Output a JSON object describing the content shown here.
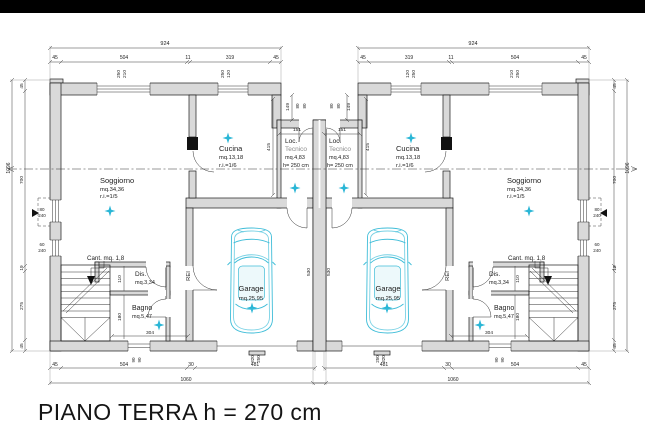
{
  "page": {
    "caption": "PIANO TERRA h = 270 cm"
  },
  "colors": {
    "letterbox": "#000000",
    "wall_fill": "#d9d9d9",
    "line": "#1a1a1a",
    "dimension": "#3c3c3c",
    "car_accent": "#3fbdd8",
    "star_accent": "#2ab6d6"
  },
  "rooms": [
    {
      "name": "Soggiorno",
      "area": "mq.34,36",
      "note": "r.i.=1/5"
    },
    {
      "name": "Cucina",
      "area": "mq.13,18",
      "note": "r.i.=1/6"
    },
    {
      "name": "Loc. Tecnico",
      "area": "mq.4,83",
      "note": "h= 250 cm"
    },
    {
      "name": "Garage",
      "area": "mq.25,95",
      "note": ""
    },
    {
      "name": "Dis.",
      "area": "mq.3,34",
      "note": ""
    },
    {
      "name": "Bagno",
      "area": "mq.5,47",
      "note": ""
    },
    {
      "name": "Cant.",
      "area": "mq. 1,8",
      "note": ""
    }
  ],
  "plan": {
    "labels": [
      {
        "t": "924",
        "x": 165,
        "y": 45,
        "s": 5.5
      },
      {
        "t": "924",
        "x": 473,
        "y": 45,
        "s": 5.5
      },
      {
        "t": "45",
        "x": 55,
        "y": 59,
        "s": 5
      },
      {
        "t": "504",
        "x": 124,
        "y": 59,
        "s": 5
      },
      {
        "t": "11",
        "x": 188,
        "y": 59,
        "s": 5
      },
      {
        "t": "319",
        "x": 230,
        "y": 59,
        "s": 5
      },
      {
        "t": "45",
        "x": 276,
        "y": 59,
        "s": 5
      },
      {
        "t": "45",
        "x": 363,
        "y": 59,
        "s": 5
      },
      {
        "t": "319",
        "x": 409,
        "y": 59,
        "s": 5
      },
      {
        "t": "11",
        "x": 451,
        "y": 59,
        "s": 5
      },
      {
        "t": "504",
        "x": 515,
        "y": 59,
        "s": 5
      },
      {
        "t": "45",
        "x": 584,
        "y": 59,
        "s": 5
      },
      {
        "t": "250",
        "x": 120,
        "y": 74,
        "r": -90,
        "s": 4.8
      },
      {
        "t": "210",
        "x": 126,
        "y": 74,
        "r": -90,
        "s": 4.8
      },
      {
        "t": "250",
        "x": 224,
        "y": 74,
        "r": -90,
        "s": 4.8
      },
      {
        "t": "120",
        "x": 230,
        "y": 74,
        "r": -90,
        "s": 4.8
      },
      {
        "t": "120",
        "x": 409,
        "y": 74,
        "r": -90,
        "s": 4.8
      },
      {
        "t": "250",
        "x": 415,
        "y": 74,
        "r": -90,
        "s": 4.8
      },
      {
        "t": "210",
        "x": 513,
        "y": 74,
        "r": -90,
        "s": 4.8
      },
      {
        "t": "250",
        "x": 519,
        "y": 74,
        "r": -90,
        "s": 4.8
      },
      {
        "t": "149",
        "x": 289,
        "y": 107,
        "r": -90,
        "s": 4.8
      },
      {
        "t": "149",
        "x": 350,
        "y": 107,
        "r": -90,
        "s": 4.8
      },
      {
        "t": "80",
        "x": 299,
        "y": 106,
        "r": -90,
        "s": 4.5
      },
      {
        "t": "80",
        "x": 306,
        "y": 106,
        "r": -90,
        "s": 4.5
      },
      {
        "t": "80",
        "x": 333,
        "y": 106,
        "r": -90,
        "s": 4.5
      },
      {
        "t": "80",
        "x": 340,
        "y": 106,
        "r": -90,
        "s": 4.5
      },
      {
        "t": "151",
        "x": 297,
        "y": 131,
        "s": 4.8
      },
      {
        "t": "151",
        "x": 342,
        "y": 131,
        "s": 4.8
      },
      {
        "t": "415",
        "x": 270,
        "y": 147,
        "r": -90,
        "s": 4.8
      },
      {
        "t": "415",
        "x": 369,
        "y": 147,
        "r": -90,
        "s": 4.8
      },
      {
        "t": "1096",
        "x": 10,
        "y": 168,
        "r": -90,
        "s": 5
      },
      {
        "t": "1096",
        "x": 629,
        "y": 168,
        "r": -90,
        "s": 5
      },
      {
        "t": "45",
        "x": 23,
        "y": 86,
        "r": -90,
        "s": 4.8
      },
      {
        "t": "700",
        "x": 23,
        "y": 180,
        "r": -90,
        "s": 4.8
      },
      {
        "t": "19",
        "x": 23,
        "y": 268,
        "r": -90,
        "s": 4.8
      },
      {
        "t": "275",
        "x": 23,
        "y": 306,
        "r": -90,
        "s": 4.8
      },
      {
        "t": "45",
        "x": 23,
        "y": 346,
        "r": -90,
        "s": 4.8
      },
      {
        "t": "45",
        "x": 616,
        "y": 86,
        "r": -90,
        "s": 4.8
      },
      {
        "t": "700",
        "x": 616,
        "y": 180,
        "r": -90,
        "s": 4.8
      },
      {
        "t": "19",
        "x": 616,
        "y": 268,
        "r": -90,
        "s": 4.8
      },
      {
        "t": "275",
        "x": 616,
        "y": 306,
        "r": -90,
        "s": 4.8
      },
      {
        "t": "45",
        "x": 616,
        "y": 346,
        "r": -90,
        "s": 4.8
      },
      {
        "t": "80",
        "x": 42,
        "y": 211,
        "s": 4.5
      },
      {
        "t": "240",
        "x": 42,
        "y": 217,
        "s": 4.5
      },
      {
        "t": "60",
        "x": 42,
        "y": 246,
        "s": 4.5
      },
      {
        "t": "240",
        "x": 42,
        "y": 252,
        "s": 4.5
      },
      {
        "t": "80",
        "x": 597,
        "y": 211,
        "s": 4.5
      },
      {
        "t": "240",
        "x": 597,
        "y": 217,
        "s": 4.5
      },
      {
        "t": "60",
        "x": 597,
        "y": 246,
        "s": 4.5
      },
      {
        "t": "240",
        "x": 597,
        "y": 252,
        "s": 4.5
      },
      {
        "t": "45",
        "x": 55,
        "y": 366,
        "s": 5
      },
      {
        "t": "504",
        "x": 124,
        "y": 366,
        "s": 5
      },
      {
        "t": "30",
        "x": 191,
        "y": 366,
        "s": 5
      },
      {
        "t": "481",
        "x": 255,
        "y": 366,
        "s": 5
      },
      {
        "t": "481",
        "x": 384,
        "y": 366,
        "s": 5
      },
      {
        "t": "30",
        "x": 448,
        "y": 366,
        "s": 5
      },
      {
        "t": "504",
        "x": 515,
        "y": 366,
        "s": 5
      },
      {
        "t": "45",
        "x": 584,
        "y": 366,
        "s": 5
      },
      {
        "t": "1060",
        "x": 186,
        "y": 381,
        "s": 5
      },
      {
        "t": "1060",
        "x": 453,
        "y": 381,
        "s": 5
      },
      {
        "t": "90",
        "x": 135,
        "y": 360,
        "r": -90,
        "s": 4.5
      },
      {
        "t": "90",
        "x": 141,
        "y": 360,
        "r": -90,
        "s": 4.5
      },
      {
        "t": "320",
        "x": 254,
        "y": 359,
        "r": -90,
        "s": 4.5
      },
      {
        "t": "250",
        "x": 260,
        "y": 359,
        "r": -90,
        "s": 4.5
      },
      {
        "t": "250",
        "x": 379,
        "y": 359,
        "r": -90,
        "s": 4.5
      },
      {
        "t": "320",
        "x": 385,
        "y": 359,
        "r": -90,
        "s": 4.5
      },
      {
        "t": "90",
        "x": 498,
        "y": 360,
        "r": -90,
        "s": 4.5
      },
      {
        "t": "90",
        "x": 504,
        "y": 360,
        "r": -90,
        "s": 4.5
      },
      {
        "t": "304",
        "x": 150,
        "y": 334,
        "s": 4.8
      },
      {
        "t": "304",
        "x": 489,
        "y": 334,
        "s": 4.8
      },
      {
        "t": "530",
        "x": 310,
        "y": 272,
        "r": -90,
        "s": 4.8
      },
      {
        "t": "530",
        "x": 330,
        "y": 272,
        "r": -90,
        "s": 4.8
      },
      {
        "t": "110",
        "x": 121,
        "y": 279,
        "r": -90,
        "s": 4.8
      },
      {
        "t": "180",
        "x": 121,
        "y": 317,
        "r": -90,
        "s": 4.8
      },
      {
        "t": "110",
        "x": 519,
        "y": 279,
        "r": -90,
        "s": 4.8
      },
      {
        "t": "180",
        "x": 519,
        "y": 317,
        "r": -90,
        "s": 4.8
      },
      {
        "t": "Soggiorno",
        "x": 100,
        "y": 183,
        "s": 7.5,
        "a": "start",
        "n": "room-label-soggiorno"
      },
      {
        "t": "mq.34,36",
        "x": 100,
        "y": 191,
        "s": 5.8,
        "a": "start"
      },
      {
        "t": "r.i.=1/5",
        "x": 100,
        "y": 198,
        "s": 5.8,
        "a": "start"
      },
      {
        "t": "Cucina",
        "x": 219,
        "y": 151,
        "s": 7.5,
        "a": "start",
        "n": "room-label-cucina"
      },
      {
        "t": "mq.13,18",
        "x": 219,
        "y": 159,
        "s": 5.8,
        "a": "start"
      },
      {
        "t": "r.i.=1/6",
        "x": 219,
        "y": 167,
        "s": 5.8,
        "a": "start"
      },
      {
        "t": "Loc.",
        "x": 285,
        "y": 143,
        "s": 6.5,
        "a": "start",
        "n": "room-label-loc-tecnico"
      },
      {
        "t": "Tecnico",
        "x": 285,
        "y": 151,
        "s": 6.5,
        "a": "start",
        "c": "#8a8a8a"
      },
      {
        "t": "mq.4,83",
        "x": 285,
        "y": 159,
        "s": 5.5,
        "a": "start"
      },
      {
        "t": "h= 250 cm",
        "x": 283,
        "y": 167,
        "s": 5.5,
        "a": "start"
      },
      {
        "t": "Cant. mq. 1,8",
        "x": 87,
        "y": 260,
        "s": 6.2,
        "a": "start",
        "n": "room-label-cantina"
      },
      {
        "t": "Dis.",
        "x": 135,
        "y": 276,
        "s": 6.5,
        "a": "start",
        "n": "room-label-dis"
      },
      {
        "t": "mq.3,34",
        "x": 135,
        "y": 284,
        "s": 5.5,
        "a": "start"
      },
      {
        "t": "Bagno",
        "x": 132,
        "y": 310,
        "s": 7,
        "a": "start",
        "n": "room-label-bagno"
      },
      {
        "t": "mq.5,47",
        "x": 132,
        "y": 318,
        "s": 5.5,
        "a": "start"
      },
      {
        "t": "REI",
        "x": 190,
        "y": 276,
        "r": -90,
        "s": 5.8,
        "n": "rei-wall-label"
      },
      {
        "t": "Garage",
        "x": 251,
        "y": 291,
        "s": 7.5,
        "n": "room-label-garage"
      },
      {
        "t": "mq.25,95",
        "x": 251,
        "y": 300,
        "s": 5.8
      },
      {
        "t": "Soggiorno",
        "x": 507,
        "y": 183,
        "s": 7.5,
        "a": "start",
        "n": "room-label-soggiorno-b"
      },
      {
        "t": "mq.34,36",
        "x": 507,
        "y": 191,
        "s": 5.8,
        "a": "start"
      },
      {
        "t": "r.i.=1/5",
        "x": 507,
        "y": 198,
        "s": 5.8,
        "a": "start"
      },
      {
        "t": "Cucina",
        "x": 396,
        "y": 151,
        "s": 7.5,
        "a": "start",
        "n": "room-label-cucina-b"
      },
      {
        "t": "mq.13,18",
        "x": 396,
        "y": 159,
        "s": 5.8,
        "a": "start"
      },
      {
        "t": "r.i.=1/6",
        "x": 396,
        "y": 167,
        "s": 5.8,
        "a": "start"
      },
      {
        "t": "Loc.",
        "x": 329,
        "y": 143,
        "s": 6.5,
        "a": "start",
        "n": "room-label-loc-tecnico-b"
      },
      {
        "t": "Tecnico",
        "x": 329,
        "y": 151,
        "s": 6.5,
        "a": "start",
        "c": "#8a8a8a"
      },
      {
        "t": "mq.4,83",
        "x": 329,
        "y": 159,
        "s": 5.5,
        "a": "start"
      },
      {
        "t": "h= 250 cm",
        "x": 327,
        "y": 167,
        "s": 5.5,
        "a": "start"
      },
      {
        "t": "Cant. mq. 1,8",
        "x": 508,
        "y": 260,
        "s": 6.2,
        "a": "start",
        "n": "room-label-cantina-b"
      },
      {
        "t": "Dis.",
        "x": 489,
        "y": 276,
        "s": 6.5,
        "a": "start",
        "n": "room-label-dis-b"
      },
      {
        "t": "mq.3,34",
        "x": 489,
        "y": 284,
        "s": 5.5,
        "a": "start"
      },
      {
        "t": "Bagno",
        "x": 494,
        "y": 310,
        "s": 7,
        "a": "start",
        "n": "room-label-bagno-b"
      },
      {
        "t": "mq.5,47",
        "x": 494,
        "y": 318,
        "s": 5.5,
        "a": "start"
      },
      {
        "t": "REI",
        "x": 449,
        "y": 276,
        "r": -90,
        "s": 5.8,
        "n": "rei-wall-label-b"
      },
      {
        "t": "Garage",
        "x": 388,
        "y": 291,
        "s": 7.5,
        "n": "room-label-garage-b"
      },
      {
        "t": "mq.25,95",
        "x": 388,
        "y": 300,
        "s": 5.8
      }
    ]
  }
}
